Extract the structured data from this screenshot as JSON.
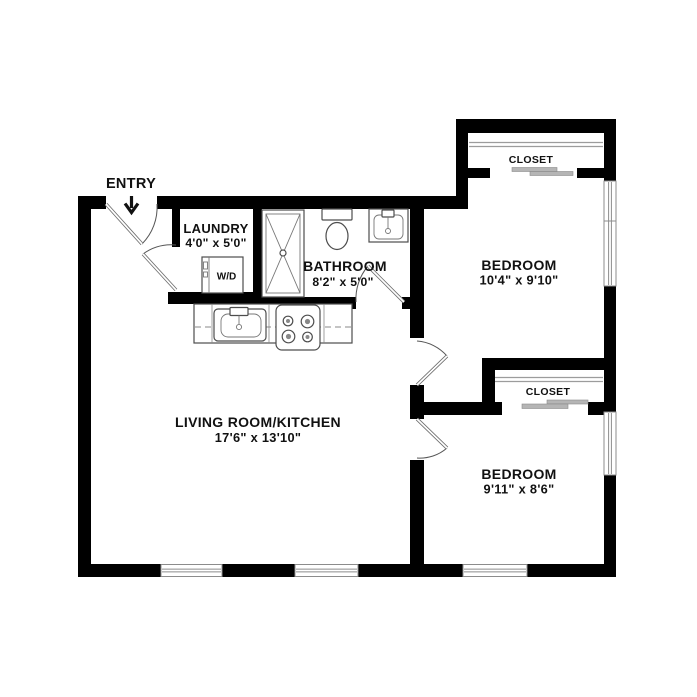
{
  "entry": {
    "label": "ENTRY"
  },
  "rooms": {
    "laundry": {
      "label": "LAUNDRY",
      "dimensions": "4'0\" x 5'0\""
    },
    "bathroom": {
      "label": "BATHROOM",
      "dimensions": "8'2\" x 5'0\""
    },
    "bedroom1": {
      "label": "BEDROOM",
      "dimensions": "10'4\" x 9'10\"",
      "closet": "CLOSET"
    },
    "bedroom2": {
      "label": "BEDROOM",
      "dimensions": "9'11\" x 8'6\"",
      "closet": "CLOSET"
    },
    "living_kitchen": {
      "label": "LIVING ROOM/KITCHEN",
      "dimensions": "17'6\" x 13'10\""
    }
  },
  "appliances": {
    "washer_dryer": "W/D"
  },
  "colors": {
    "wall": "#000000",
    "window_frame": "#8c8c8c",
    "fixture_line": "#4d4d4d",
    "closet_slider": "#b5b5b5",
    "label_text": "#111111",
    "background": "#ffffff"
  }
}
